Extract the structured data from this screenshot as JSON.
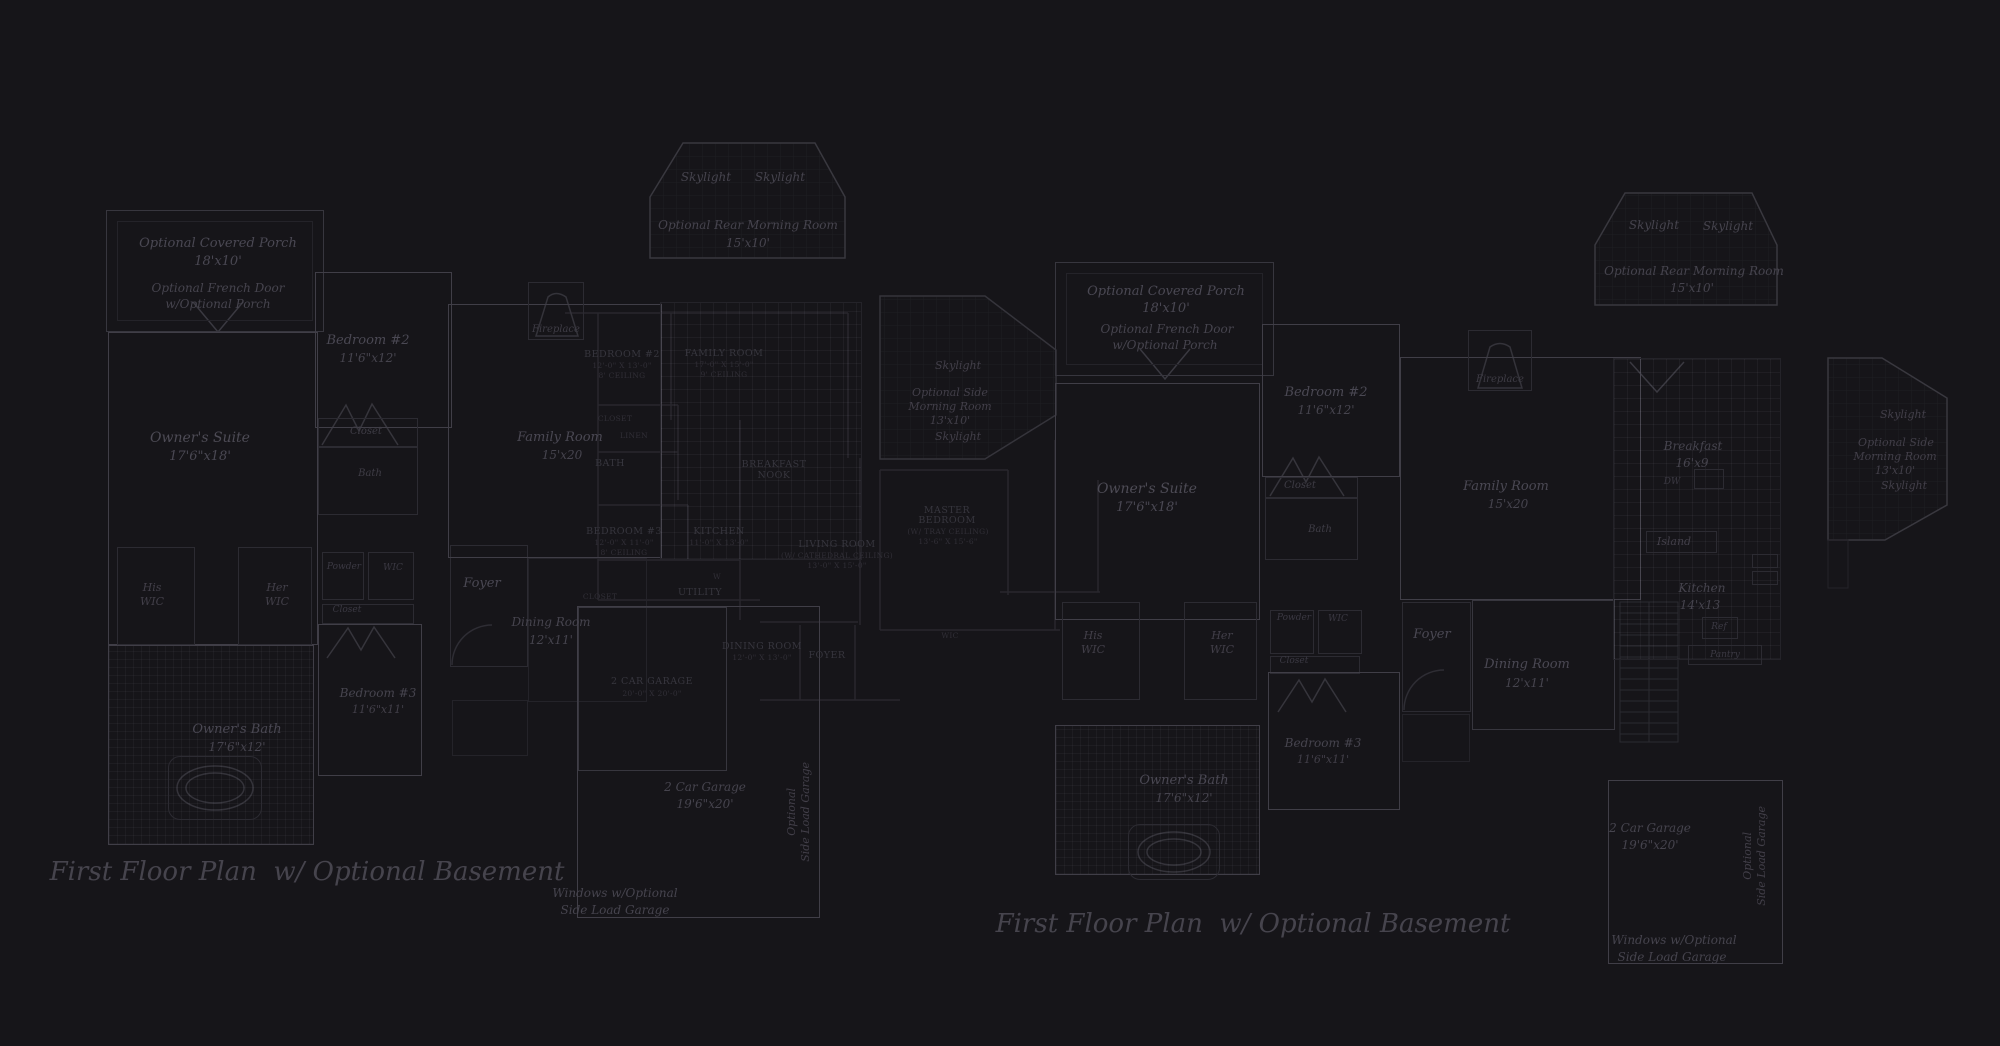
{
  "colors": {
    "background": "#161519",
    "wall_bright": "#403e47",
    "wall_medium": "#2c2b32",
    "wall_faint": "#242329",
    "label_text": "#4a4853",
    "basement_text": "#37363e",
    "caption_text": "#46444d"
  },
  "captions": {
    "left": "First Floor Plan  w/ Optional Basement",
    "right": "First Floor Plan  w/ Optional Basement"
  },
  "left": {
    "porch": "Optional Covered Porch",
    "porch_dims": "18'x10'",
    "french1": "Optional French Door",
    "french2": "w/Optional Porch",
    "suite": "Owner's Suite",
    "suite_dims": "17'6\"x18'",
    "bed2": "Bedroom #2",
    "bed2_dims": "11'6\"x12'",
    "closet": "Closet",
    "bath": "Bath",
    "his": "His",
    "her": "Her",
    "wic": "WIC",
    "powder": "Powder",
    "closet2": "Closet",
    "obath": "Owner's Bath",
    "obath_dims": "17'6\"x12'",
    "bed3": "Bedroom #3",
    "bed3_dims": "11'6\"x11'",
    "foyer": "Foyer",
    "dining": "Dining Room",
    "dining_dims": "12'x11'",
    "family": "Family Room",
    "family_dims": "15'x20",
    "fireplace": "Fireplace",
    "sky": "Skylight",
    "rear_morning": "Optional Rear Morning Room",
    "rear_morning_dims": "15'x10'",
    "side1": "Optional Side",
    "side2": "Morning Room",
    "side_dims": "13'x10'",
    "garage": "2 Car Garage",
    "garage_dims": "19'6\"x20'",
    "opt1": "Optional",
    "opt2": "Side Load Garage",
    "win1": "Windows w/Optional",
    "win2": "Side Load Garage"
  },
  "right": {
    "porch": "Optional Covered Porch",
    "porch_dims": "18'x10'",
    "french1": "Optional French Door",
    "french2": "w/Optional Porch",
    "suite": "Owner's Suite",
    "suite_dims": "17'6\"x18'",
    "bed2": "Bedroom #2",
    "bed2_dims": "11'6\"x12'",
    "closet": "Closet",
    "bath": "Bath",
    "his": "His",
    "her": "Her",
    "wic": "WIC",
    "powder": "Powder",
    "closet2": "Closet",
    "obath": "Owner's Bath",
    "obath_dims": "17'6\"x12'",
    "bed3": "Bedroom #3",
    "bed3_dims": "11'6\"x11'",
    "foyer": "Foyer",
    "dining": "Dining Room",
    "dining_dims": "12'x11'",
    "family": "Family Room",
    "family_dims": "15'x20",
    "fireplace": "Fireplace",
    "sky": "Skylight",
    "rear_morning": "Optional Rear Morning Room",
    "rear_morning_dims": "15'x10'",
    "breakfast": "Breakfast",
    "breakfast_dims": "16'x9",
    "dw": "DW",
    "island": "Island",
    "kitchen": "Kitchen",
    "kitchen_dims": "14'x13",
    "ref": "Ref",
    "pantry": "Pantry",
    "side1": "Optional Side",
    "side2": "Morning Room",
    "side_dims": "13'x10'",
    "garage": "2 Car Garage",
    "garage_dims": "19'6\"x20'",
    "opt1": "Optional",
    "opt2": "Side Load Garage",
    "win1": "Windows w/Optional",
    "win2": "Side Load Garage"
  },
  "basement": {
    "bed2": "BEDROOM #2",
    "bed2_d1": "12'-0\" X 13'-0\"",
    "bed2_d2": "8' CEILING",
    "family": "FAMILY ROOM",
    "family_d1": "17'-0\" X 15'-0\"",
    "family_d2": "9' CEILING",
    "closet": "CLOSET",
    "linen": "LINEN",
    "bath": "BATH",
    "bed3": "BEDROOM #3",
    "bed3_d1": "12'-0\" X 11'-0\"",
    "bed3_d2": "8' CEILING",
    "kitchen": "KITCHEN",
    "kitchen_d1": "11'-0\" X 13'-0\"",
    "breakfast1": "BREAKFAST",
    "breakfast2": "NOOK",
    "utility": "UTILITY",
    "w": "W",
    "closet2": "CLOSET",
    "dining": "DINING ROOM",
    "dining_d1": "12'-0\" X 13'-0\"",
    "foyer": "FOYER",
    "living": "LIVING ROOM",
    "living_d1": "(W/ CATHEDRAL CEILING)",
    "living_d2": "13'-0\" X 15'-0\"",
    "master1": "MASTER",
    "master2": "BEDROOM",
    "master_d1": "(W/ TRAY CEILING)",
    "master_d2": "13'-6\" X 15'-6\"",
    "garage": "2 CAR GARAGE",
    "garage_d1": "20'-0\" X 20'-0\"",
    "wic": "WIC"
  }
}
